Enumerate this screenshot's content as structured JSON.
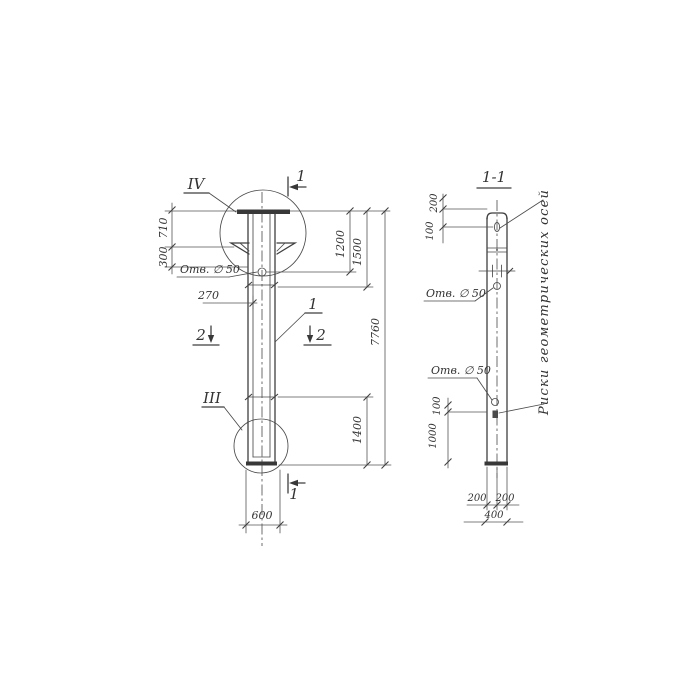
{
  "left_view": {
    "detail_top_label": "IV",
    "detail_bottom_label": "III",
    "section_cut_top": "1",
    "section_cut_bottom": "1",
    "section_cut2_left": "2",
    "section_cut2_right": "2",
    "part_callout": "1",
    "hole_callout": "Отв. ∅ 50",
    "dims": {
      "cap_height": "710",
      "flange_height": "300",
      "hole_offset": "270",
      "hole_from_top": "1200",
      "upper_segment": "1500",
      "total_length": "7760",
      "lower_segment": "1400",
      "width": "600"
    }
  },
  "section_view": {
    "title": "1-1",
    "hole_callout_upper": "Отв. ∅ 50",
    "hole_callout_lower": "Отв. ∅ 50",
    "axes_note": "Риски геометрических осей",
    "dims": {
      "top_200": "200",
      "top_100": "100",
      "bottom_100": "100",
      "bottom_1000": "1000",
      "width_left_200": "200",
      "width_right_200": "200",
      "width_total_400": "400"
    }
  },
  "colors": {
    "ink": "#3f3f3f",
    "paper": "#ffffff"
  }
}
